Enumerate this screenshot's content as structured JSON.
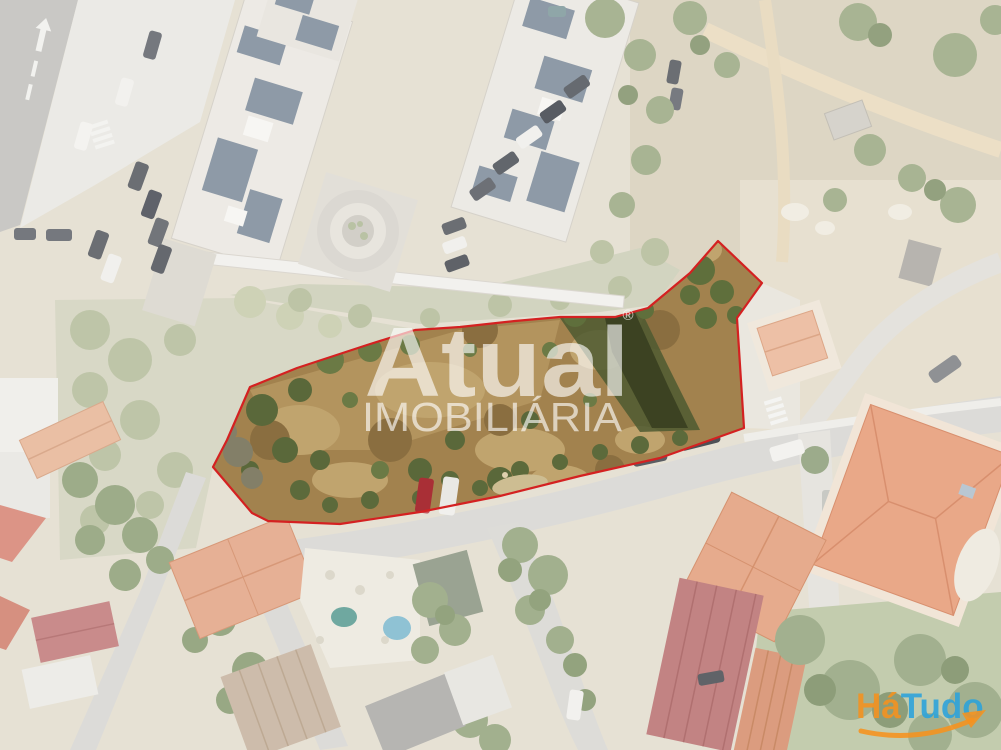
{
  "scene": {
    "type": "aerial-drone-photo",
    "fade_color": "#ffffff"
  },
  "plot_boundary": {
    "stroke_color": "#D42121",
    "points": "718,241 762,283 737,318 744,428 660,458 580,476 500,496 420,512 340,524 268,521 252,513 213,467 227,440 250,387 297,368 367,345 415,330 460,327 515,321 560,317 615,317 648,308 690,273"
  },
  "watermark": {
    "brand": "Atual",
    "registered_mark": "®",
    "subtitle": "IMOBILIÁRIA",
    "color": "#ffffff"
  },
  "agency_logo": {
    "text_part1": "Há",
    "text_part2": "Tudo",
    "part1_color": "#F6921E",
    "part2_color": "#2BA3DC",
    "arrow_color": "#F6921E"
  }
}
